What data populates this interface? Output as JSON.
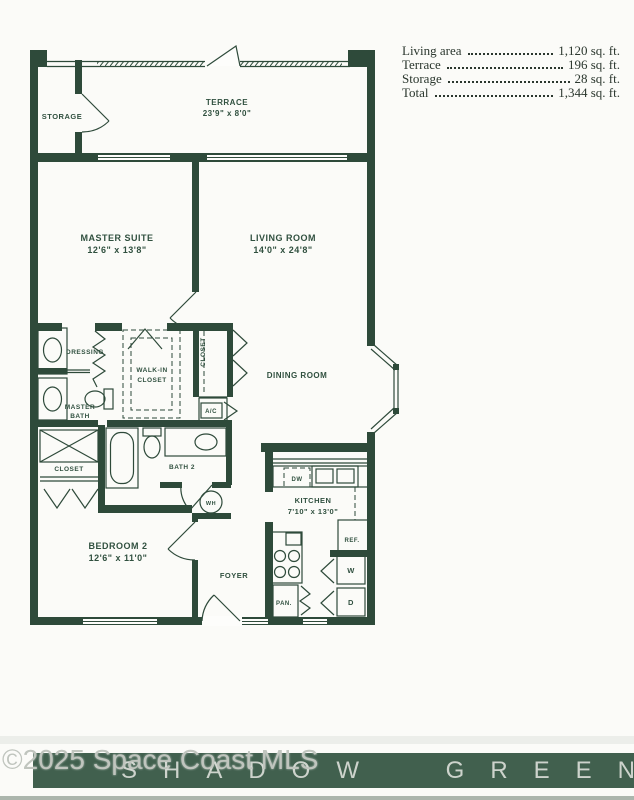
{
  "area_table": {
    "rows": [
      {
        "label": "Living area",
        "value": "1,120 sq. ft."
      },
      {
        "label": "Terrace",
        "value": "196 sq. ft."
      },
      {
        "label": "Storage",
        "value": "28 sq. ft."
      },
      {
        "label": "Total",
        "value": "1,344 sq. ft."
      }
    ]
  },
  "plan": {
    "rooms": {
      "storage": {
        "name": "STORAGE"
      },
      "terrace": {
        "name": "TERRACE",
        "dims": "23'9\" x 8'0\""
      },
      "master_suite": {
        "name": "MASTER SUITE",
        "dims": "12'6\" x 13'8\""
      },
      "living_room": {
        "name": "LIVING ROOM",
        "dims": "14'0\" x 24'8\""
      },
      "dressing": {
        "name": "DRESSING"
      },
      "walk_in_closet": {
        "line1": "WALK-IN",
        "line2": "CLOSET"
      },
      "closet_hall": {
        "name": "CLOSET"
      },
      "master_bath": {
        "line1": "MASTER",
        "line2": "BATH"
      },
      "dining_room": {
        "name": "DINING ROOM"
      },
      "closet_bed": {
        "name": "CLOSET"
      },
      "bath2": {
        "name": "BATH 2"
      },
      "kitchen": {
        "name": "KITCHEN",
        "dims": "7'10\" x 13'0\""
      },
      "bedroom2": {
        "name": "BEDROOM 2",
        "dims": "12'6\" x 11'0\""
      },
      "foyer": {
        "name": "FOYER"
      }
    },
    "fixtures": {
      "ac": "A/C",
      "wh": "WH",
      "dw": "DW",
      "ref": "REF.",
      "pantry": "PAN.",
      "washer": "W",
      "dryer": "D"
    }
  },
  "footer": {
    "watermark": "©2025 Space Coast MLS",
    "banner": "SHADOW GREEN"
  },
  "colors": {
    "wall_green": "#2e4a3a",
    "banner_green": "#41604e",
    "banner_text": "#cdd3cc",
    "table_text": "#2b372e"
  }
}
